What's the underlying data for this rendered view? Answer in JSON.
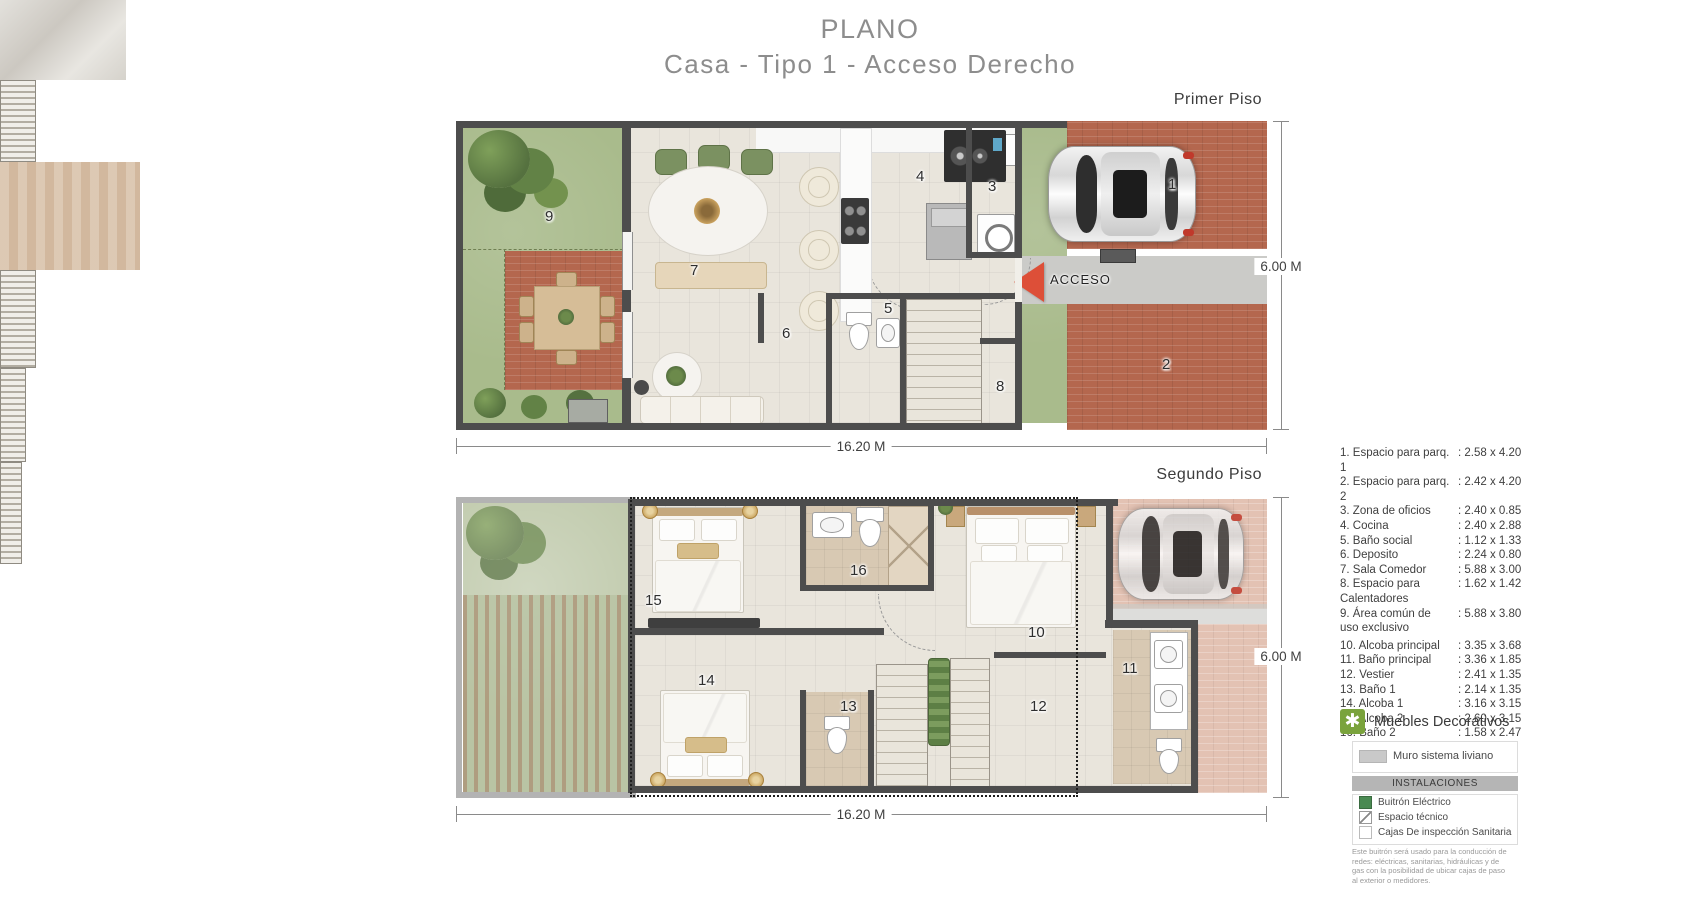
{
  "title": {
    "line1": "PLANO",
    "line2": "Casa - Tipo 1 - Acceso Derecho"
  },
  "floors": {
    "floor1": {
      "label": "Primer Piso",
      "width_dim": "16.20 M",
      "height_dim": "6.00 M",
      "acceso": "ACCESO",
      "rooms": {
        "n1": "1",
        "n2": "2",
        "n3": "3",
        "n4": "4",
        "n5": "5",
        "n6": "6",
        "n7": "7",
        "n8": "8",
        "n9": "9"
      }
    },
    "floor2": {
      "label": "Segundo Piso",
      "width_dim": "16.20 M",
      "height_dim": "6.00 M",
      "rooms": {
        "n10": "10",
        "n11": "11",
        "n12": "12",
        "n13": "13",
        "n14": "14",
        "n15": "15",
        "n16": "16"
      }
    }
  },
  "legend": {
    "items": [
      {
        "num": "1.",
        "name": "Espacio para parq. 1",
        "dims": ": 2.58 x 4.20"
      },
      {
        "num": "2.",
        "name": "Espacio para parq. 2",
        "dims": ": 2.42 x 4.20"
      },
      {
        "num": "3.",
        "name": "Zona de oficios",
        "dims": ": 2.40 x 0.85"
      },
      {
        "num": "4.",
        "name": "Cocina",
        "dims": ": 2.40 x 2.88"
      },
      {
        "num": "5.",
        "name": "Baño social",
        "dims": ": 1.12 x 1.33"
      },
      {
        "num": "6.",
        "name": "Deposito",
        "dims": ": 2.24 x 0.80"
      },
      {
        "num": "7.",
        "name": "Sala Comedor",
        "dims": ": 5.88 x 3.00"
      },
      {
        "num": "8.",
        "name": "Espacio para",
        "name2": "Calentadores",
        "dims": ": 1.62 x 1.42"
      },
      {
        "num": "9.",
        "name": "Área común de",
        "name2": "uso exclusivo",
        "dims": ": 5.88 x 3.80"
      },
      {
        "num": "10.",
        "name": "Alcoba principal",
        "dims": ": 3.35 x 3.68"
      },
      {
        "num": "11.",
        "name": "Baño principal",
        "dims": ": 3.36 x 1.85"
      },
      {
        "num": "12.",
        "name": "Vestier",
        "dims": ": 2.41 x 1.35"
      },
      {
        "num": "13.",
        "name": "Baño 1",
        "dims": ": 2.14 x 1.35"
      },
      {
        "num": "14.",
        "name": "Alcoba 1",
        "dims": ": 3.16 x 3.15"
      },
      {
        "num": "15.",
        "name": "Alcoba 2",
        "dims": ": 2.60 x 3.15"
      },
      {
        "num": "16.",
        "name": "Baño 2",
        "dims": ": 1.58 x 2.47"
      }
    ],
    "muebles": {
      "icon_glyph": "✱",
      "label": "Muebles Decorativos"
    },
    "muro_label": "Muro sistema liviano",
    "instalaciones": {
      "header": "INSTALACIONES",
      "items": [
        {
          "label": "Buitrón Eléctrico",
          "swatch": "green"
        },
        {
          "label": "Espacio técnico",
          "swatch": "diagonal-line"
        },
        {
          "label": "Cajas De inspección Sanitaria",
          "swatch": "white"
        }
      ],
      "note": "Este buitrón será usado para la conducción de redes: eléctricas, sanitarias, hidráulicas y de gas con la posibilidad de ubicar cajas de paso al exterior o medidores."
    }
  },
  "colors": {
    "wall": "#4d4d4d",
    "floor": "#e9e5dc",
    "grass": "#a9bb8c",
    "grass_faded": "#c0caac",
    "brick": "#b4674e",
    "brick_faded": "#e3c2b3",
    "path": "#cbcbc8",
    "acceso_red": "#dd4f38",
    "bath": "#d8c9b3",
    "legend_green": "#7aa33c",
    "buitron_green": "#4a8a52",
    "text": "#3f3f3f",
    "title": "#8d8d8d"
  }
}
